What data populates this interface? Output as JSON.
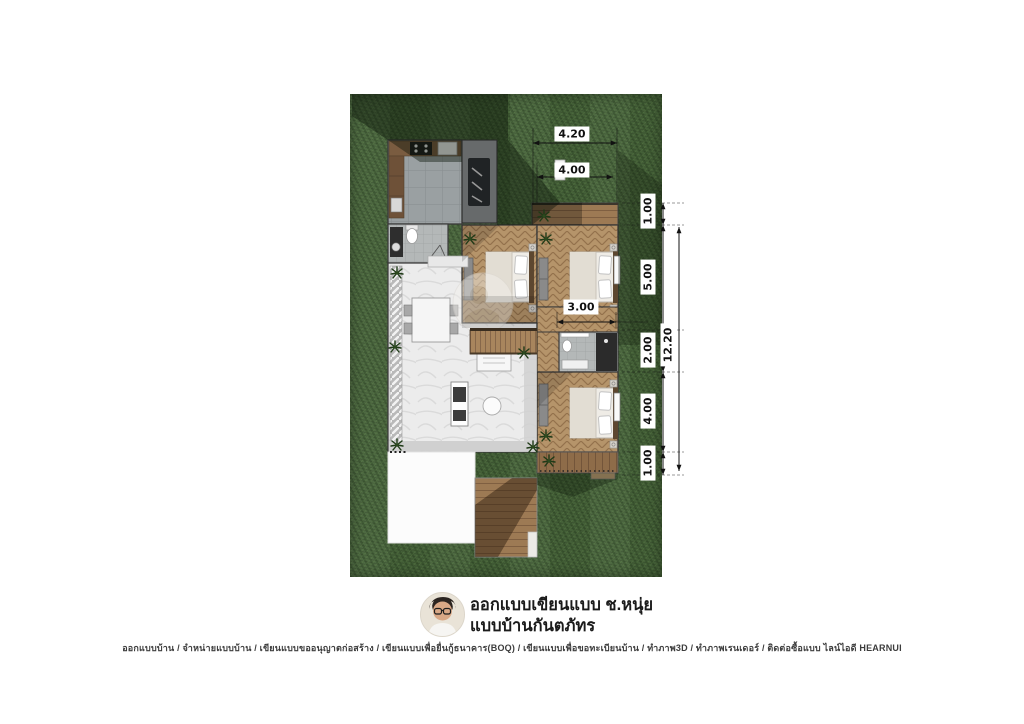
{
  "plan": {
    "colors": {
      "lawn_green": "#48653b",
      "shadow_green": "#1e3312",
      "herringbone_wood": "#b5946a",
      "deck_wood": "#96744f",
      "marble_floor": "#ededed",
      "tile_gray": "#9aa0a2",
      "wall_line": "#3a3a3a",
      "dimension_text": "#111111"
    },
    "rooms": [
      {
        "name": "kitchen"
      },
      {
        "name": "bathroom-1"
      },
      {
        "name": "covered-patio"
      },
      {
        "name": "terrace"
      },
      {
        "name": "bedroom-1"
      },
      {
        "name": "bedroom-2"
      },
      {
        "name": "hallway"
      },
      {
        "name": "bathroom-2"
      },
      {
        "name": "bedroom-3"
      },
      {
        "name": "living-dining-room"
      },
      {
        "name": "staircase"
      },
      {
        "name": "entry-deck"
      },
      {
        "name": "carport-pad"
      },
      {
        "name": "wood-walkway"
      }
    ]
  },
  "dimensions": {
    "top_outer": "4.20",
    "top_inner": "4.00",
    "right_1": "1.00",
    "right_2": "5.00",
    "right_3": "2.00",
    "right_4": "4.00",
    "right_5": "1.00",
    "right_total": "12.20",
    "interior_width": "3.00"
  },
  "branding": {
    "title_line1": "ออกแบบเขียนแบบ ช.หนุ่ย",
    "title_line2": "แบบบ้านกันตภัทร",
    "avatar_icon": "designer-photo"
  },
  "footer": {
    "services_line": "ออกแบบบ้าน / จำหน่ายแบบบ้าน / เขียนแบบขออนุญาตก่อสร้าง / เขียนแบบเพื่อยื่นกู้ธนาคาร(BOQ) / เขียนแบบเพื่อขอทะเบียนบ้าน / ทำภาพ3D / ทำภาพเรนเดอร์ / ติดต่อซื้อแบบ ไลน์ไอดี HEARNUI"
  }
}
